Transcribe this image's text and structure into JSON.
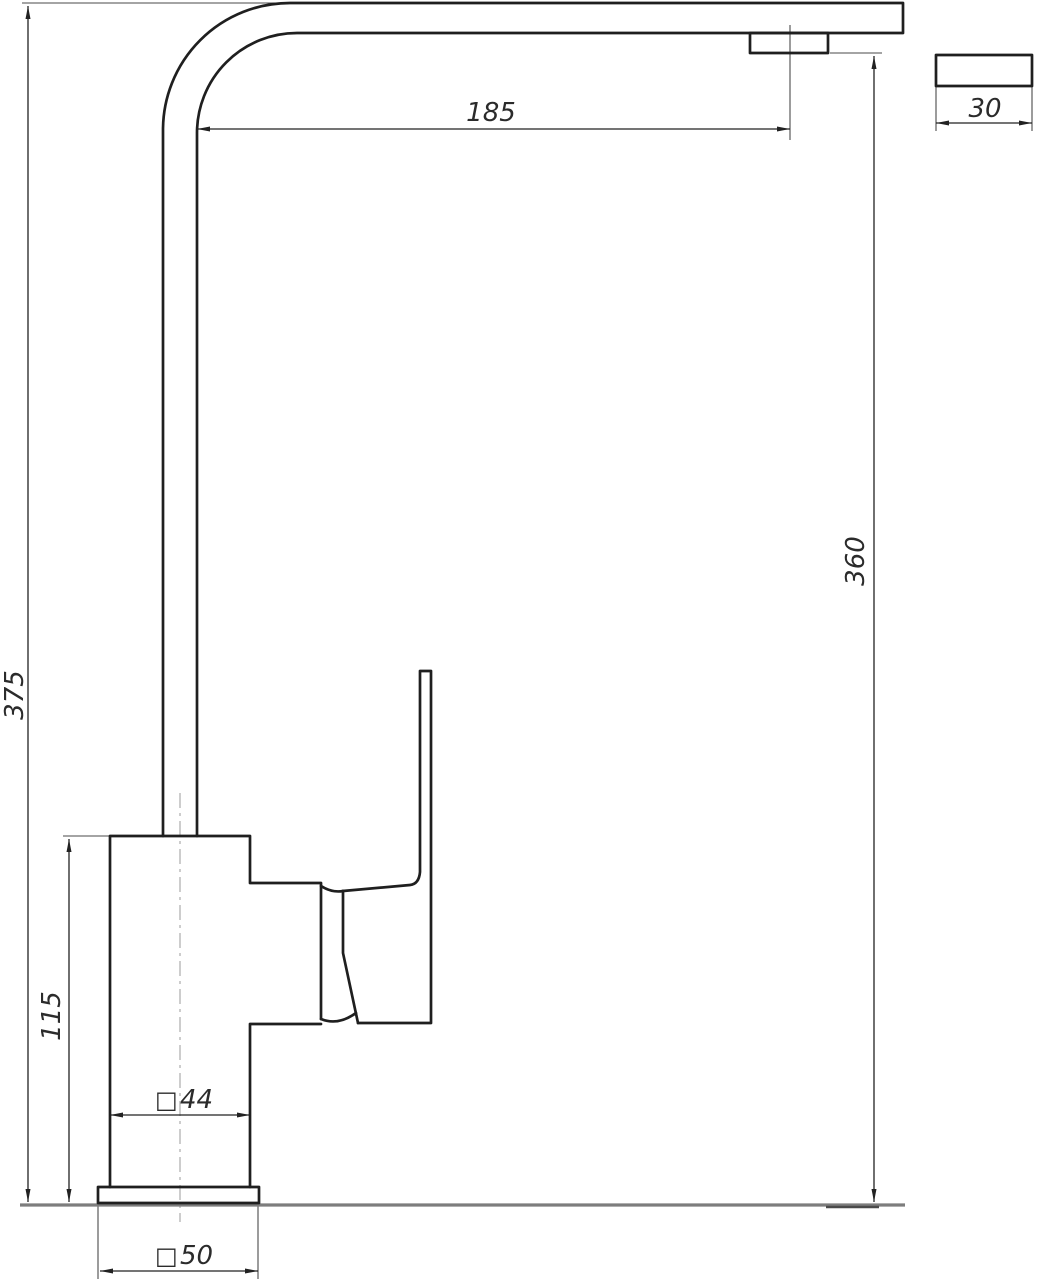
{
  "drawing": {
    "type": "technical-drawing",
    "subject": "kitchen-faucet-single-lever-side-view",
    "square_symbol": "□",
    "dimensions": {
      "spout_reach": "185",
      "spout_depth": "30",
      "spout_outlet_height": "360",
      "overall_height": "375",
      "body_height": "115",
      "body_width": "44",
      "base_width": "50"
    },
    "colors": {
      "outline": "#1f1f1f",
      "dim": "#222222",
      "thin": "#4a4a4a",
      "ground": "#7d7d7d",
      "centerline": "#9b9b9b",
      "text": "#2b2b2b",
      "background": "#ffffff"
    }
  }
}
